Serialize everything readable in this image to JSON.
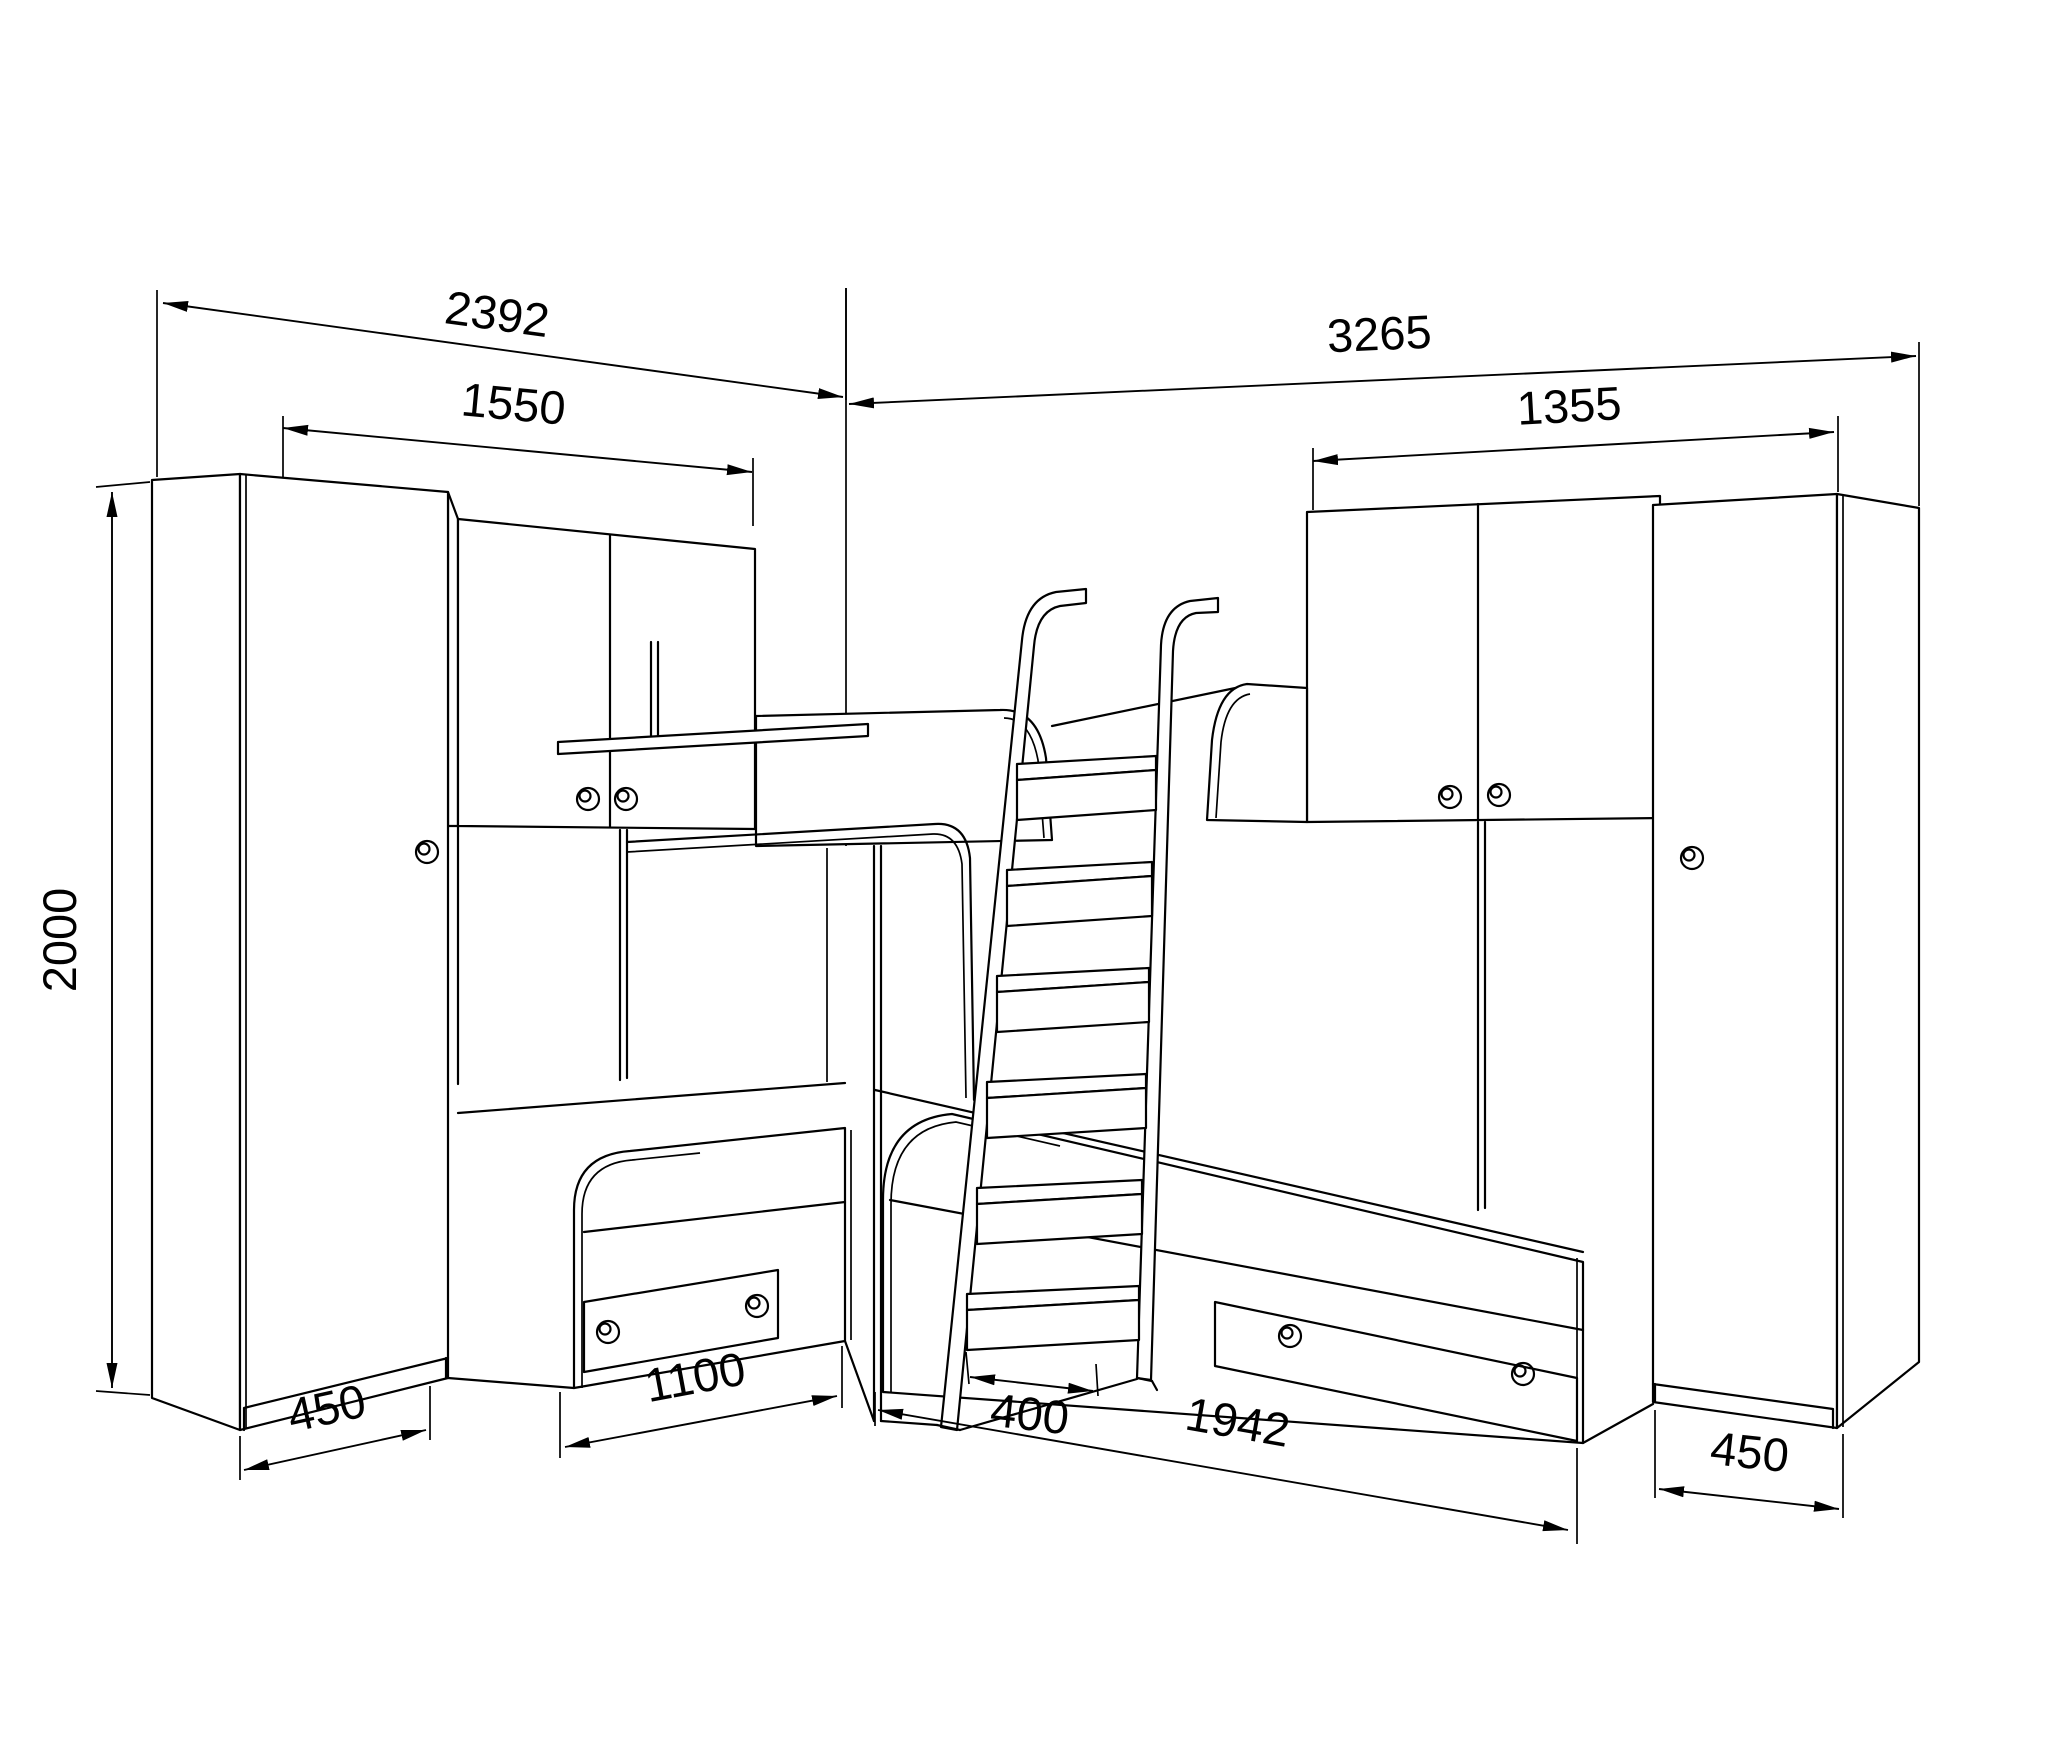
{
  "page": {
    "background": "#ffffff",
    "line_color": "#000000"
  },
  "drawing_type": "furniture-assembly-dimension-drawing",
  "dims": {
    "left_wall_total": "2392",
    "right_wall_total": "3265",
    "left_cabinets_width": "1550",
    "right_cabinets_width": "1355",
    "height": "2000",
    "left_wardrobe_depth": "450",
    "left_bed_length": "1100",
    "ladder_width": "400",
    "right_bed_length": "1942",
    "right_wardrobe_depth": "450"
  }
}
